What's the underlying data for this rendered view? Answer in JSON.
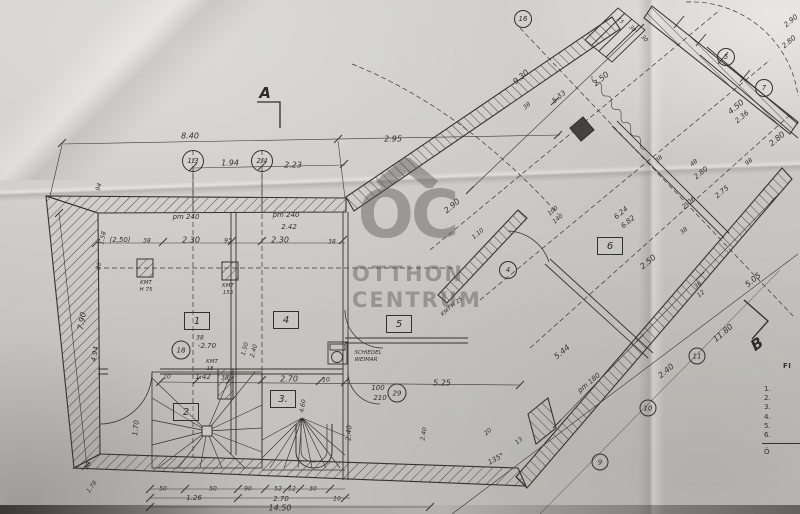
{
  "title": "Ground floor plan (hand-drawn blueprint photo)",
  "colors": {
    "paper": "#c9c8c4",
    "ink": "#33312e",
    "watermark": "#55544f"
  },
  "watermark": {
    "logo": "OC",
    "roof_icon": "roof-chevron",
    "word1": "OTTHON",
    "word2": "CENTRUM"
  },
  "section_markers": [
    {
      "label": "A",
      "x": 265,
      "y": 93,
      "rot": 0
    },
    {
      "label": "B",
      "x": 757,
      "y": 344,
      "rot": -35
    }
  ],
  "rooms": [
    {
      "label": "1",
      "x": 197,
      "y": 321
    },
    {
      "label": "2",
      "x": 186,
      "y": 412
    },
    {
      "label": "3.",
      "x": 283,
      "y": 399
    },
    {
      "label": "4",
      "x": 286,
      "y": 320
    },
    {
      "label": "5",
      "x": 399,
      "y": 324
    },
    {
      "label": "6",
      "x": 610,
      "y": 246
    }
  ],
  "axis_bubbles": [
    {
      "label": "1/3",
      "x": 193,
      "y": 161,
      "d": 20
    },
    {
      "label": "2/4",
      "x": 262,
      "y": 161,
      "d": 20
    },
    {
      "label": "18",
      "x": 181,
      "y": 350,
      "d": 17
    },
    {
      "label": "29",
      "x": 397,
      "y": 393,
      "d": 17
    },
    {
      "label": "4",
      "x": 508,
      "y": 270,
      "d": 16
    },
    {
      "label": "16",
      "x": 523,
      "y": 19,
      "d": 16
    },
    {
      "label": "5",
      "x": 726,
      "y": 57,
      "d": 16
    },
    {
      "label": "7",
      "x": 764,
      "y": 88,
      "d": 16
    },
    {
      "label": "9",
      "x": 600,
      "y": 462,
      "d": 15
    },
    {
      "label": "10",
      "x": 648,
      "y": 408,
      "d": 15
    },
    {
      "label": "11",
      "x": 697,
      "y": 356,
      "d": 15
    }
  ],
  "legend": {
    "heading": "FI",
    "items": [
      "1.",
      "2.",
      "3.",
      "4.",
      "5.",
      "6."
    ],
    "footer": "Ö"
  },
  "fixtures": [
    "spiral-stair",
    "winder-stair",
    "stove-schiedel",
    "chimney-pillar"
  ],
  "labels": [
    {
      "t": "8.40",
      "x": 190,
      "y": 136
    },
    {
      "t": "2.95",
      "x": 393,
      "y": 139
    },
    {
      "t": "1.94",
      "x": 230,
      "y": 163
    },
    {
      "t": "2.23",
      "x": 293,
      "y": 165
    },
    {
      "t": "pm 240",
      "x": 186,
      "y": 217,
      "s": 7
    },
    {
      "t": "pm 240",
      "x": 286,
      "y": 215,
      "s": 7
    },
    {
      "t": "2.42",
      "x": 289,
      "y": 227,
      "s": 7
    },
    {
      "t": "(2,50)",
      "x": 120,
      "y": 240,
      "s": 7
    },
    {
      "t": "38",
      "x": 147,
      "y": 241,
      "s": 6
    },
    {
      "t": "2.30",
      "x": 191,
      "y": 240
    },
    {
      "t": "93",
      "x": 228,
      "y": 241,
      "s": 6
    },
    {
      "t": "2.30",
      "x": 280,
      "y": 240
    },
    {
      "t": "38",
      "x": 332,
      "y": 242,
      "s": 6
    },
    {
      "t": "94",
      "x": 99,
      "y": 187,
      "r": -70,
      "s": 6
    },
    {
      "t": "1.58",
      "x": 103,
      "y": 238,
      "r": -78,
      "s": 6
    },
    {
      "t": "30",
      "x": 99,
      "y": 266,
      "r": -78,
      "s": 6
    },
    {
      "t": "7.90",
      "x": 82,
      "y": 321,
      "r": -80
    },
    {
      "t": "4.94",
      "x": 95,
      "y": 354,
      "r": -80,
      "s": 7
    },
    {
      "t": "1.70",
      "x": 136,
      "y": 428,
      "r": -84,
      "s": 7
    },
    {
      "t": "38",
      "x": 88,
      "y": 466,
      "r": -60,
      "s": 6
    },
    {
      "t": "1.78",
      "x": 92,
      "y": 487,
      "r": -55,
      "s": 6
    },
    {
      "t": "KMT",
      "x": 146,
      "y": 283,
      "s": 5.5
    },
    {
      "t": "H 75",
      "x": 146,
      "y": 290,
      "s": 5.5
    },
    {
      "t": "KMT",
      "x": 228,
      "y": 286,
      "s": 5.5
    },
    {
      "t": "155",
      "x": 228,
      "y": 293,
      "s": 5.5
    },
    {
      "t": "38",
      "x": 200,
      "y": 338,
      "s": 6
    },
    {
      "t": "-2.70",
      "x": 207,
      "y": 346,
      "s": 7
    },
    {
      "t": "1.50",
      "x": 245,
      "y": 349,
      "r": -75,
      "s": 6
    },
    {
      "t": "2.40",
      "x": 254,
      "y": 351,
      "r": -75,
      "s": 6
    },
    {
      "t": "KMT",
      "x": 212,
      "y": 362,
      "s": 5.5
    },
    {
      "t": "18",
      "x": 210,
      "y": 369,
      "s": 5.5
    },
    {
      "t": "10",
      "x": 167,
      "y": 377,
      "s": 6
    },
    {
      "t": "1.42",
      "x": 203,
      "y": 377,
      "s": 7
    },
    {
      "t": "38",
      "x": 225,
      "y": 378,
      "s": 6
    },
    {
      "t": "2.70",
      "x": 289,
      "y": 379
    },
    {
      "t": "10",
      "x": 326,
      "y": 380,
      "s": 6
    },
    {
      "t": "5.25",
      "x": 442,
      "y": 383
    },
    {
      "t": "100",
      "x": 378,
      "y": 388,
      "s": 7
    },
    {
      "t": "210",
      "x": 380,
      "y": 398,
      "s": 7
    },
    {
      "t": "SCHIEDEL",
      "x": 368,
      "y": 353,
      "s": 5.5
    },
    {
      "t": "WEIMAR",
      "x": 366,
      "y": 360,
      "s": 5.5
    },
    {
      "t": "4.60",
      "x": 303,
      "y": 406,
      "r": -80,
      "s": 6
    },
    {
      "t": "2.40",
      "x": 349,
      "y": 433,
      "r": -86,
      "s": 7
    },
    {
      "t": "2.40",
      "x": 424,
      "y": 434,
      "r": -80,
      "s": 6
    },
    {
      "t": "50",
      "x": 163,
      "y": 489,
      "s": 6
    },
    {
      "t": "50",
      "x": 213,
      "y": 489,
      "s": 6
    },
    {
      "t": "90",
      "x": 248,
      "y": 489,
      "s": 6
    },
    {
      "t": "52",
      "x": 278,
      "y": 489,
      "s": 6
    },
    {
      "t": "12",
      "x": 292,
      "y": 489,
      "s": 6
    },
    {
      "t": "30",
      "x": 313,
      "y": 489,
      "s": 6
    },
    {
      "t": "1.26",
      "x": 194,
      "y": 498,
      "s": 7
    },
    {
      "t": "2.70",
      "x": 281,
      "y": 499,
      "s": 7
    },
    {
      "t": "10",
      "x": 337,
      "y": 499,
      "s": 6
    },
    {
      "t": "14.50",
      "x": 280,
      "y": 508
    },
    {
      "t": "135°",
      "x": 496,
      "y": 459,
      "r": -28,
      "s": 7
    },
    {
      "t": "20",
      "x": 488,
      "y": 432,
      "r": -40,
      "s": 6
    },
    {
      "t": "13",
      "x": 519,
      "y": 441,
      "r": -40,
      "s": 6
    },
    {
      "t": "9.30",
      "x": 521,
      "y": 77,
      "r": -40
    },
    {
      "t": "2.50",
      "x": 601,
      "y": 79,
      "r": -40
    },
    {
      "t": "5.33",
      "x": 559,
      "y": 97,
      "r": -40,
      "s": 7
    },
    {
      "t": "38",
      "x": 527,
      "y": 106,
      "r": -40,
      "s": 6
    },
    {
      "t": "2.90",
      "x": 452,
      "y": 206,
      "r": -40
    },
    {
      "t": "1.10",
      "x": 478,
      "y": 234,
      "r": -40,
      "s": 6
    },
    {
      "t": "100",
      "x": 553,
      "y": 211,
      "r": -40,
      "s": 6
    },
    {
      "t": "140",
      "x": 558,
      "y": 219,
      "r": -40,
      "s": 6
    },
    {
      "t": "KMT H 25",
      "x": 452,
      "y": 307,
      "r": -40,
      "s": 5.5
    },
    {
      "t": "15",
      "x": 620,
      "y": 21,
      "r": 48,
      "s": 5.5
    },
    {
      "t": "30",
      "x": 632,
      "y": 29,
      "r": 48,
      "s": 5.5
    },
    {
      "t": "30",
      "x": 644,
      "y": 39,
      "r": 48,
      "s": 5.5
    },
    {
      "t": "2.90",
      "x": 791,
      "y": 21,
      "r": -40,
      "s": 7
    },
    {
      "t": "2.80",
      "x": 789,
      "y": 42,
      "r": -40,
      "s": 7
    },
    {
      "t": "4.50",
      "x": 736,
      "y": 107,
      "r": -40
    },
    {
      "t": "2.36",
      "x": 742,
      "y": 117,
      "r": -40,
      "s": 7
    },
    {
      "t": "2.80",
      "x": 777,
      "y": 139,
      "r": -40
    },
    {
      "t": "98",
      "x": 749,
      "y": 162,
      "r": -40,
      "s": 6
    },
    {
      "t": "48",
      "x": 694,
      "y": 163,
      "r": -40,
      "s": 6
    },
    {
      "t": "2.80",
      "x": 701,
      "y": 173,
      "r": -40,
      "s": 7
    },
    {
      "t": "38",
      "x": 659,
      "y": 159,
      "r": -40,
      "s": 6
    },
    {
      "t": "2.75",
      "x": 722,
      "y": 192,
      "r": -40,
      "s": 7
    },
    {
      "t": "2.06",
      "x": 689,
      "y": 203,
      "r": -40,
      "s": 7
    },
    {
      "t": "6.24",
      "x": 621,
      "y": 213,
      "r": -40,
      "s": 7
    },
    {
      "t": "6.82",
      "x": 628,
      "y": 222,
      "r": -40,
      "s": 7
    },
    {
      "t": "38",
      "x": 684,
      "y": 231,
      "r": -40,
      "s": 6
    },
    {
      "t": "2.50",
      "x": 648,
      "y": 262,
      "r": -40
    },
    {
      "t": "5.05",
      "x": 753,
      "y": 280,
      "r": -40
    },
    {
      "t": "36",
      "x": 698,
      "y": 285,
      "r": -40,
      "s": 6
    },
    {
      "t": "12",
      "x": 701,
      "y": 294,
      "r": -40,
      "s": 6
    },
    {
      "t": "5.44",
      "x": 562,
      "y": 352,
      "r": -40
    },
    {
      "t": "pm 180",
      "x": 589,
      "y": 383,
      "r": -40,
      "s": 7
    },
    {
      "t": "2.40",
      "x": 666,
      "y": 371,
      "r": -40
    },
    {
      "t": "11.80",
      "x": 723,
      "y": 333,
      "r": -40
    }
  ]
}
